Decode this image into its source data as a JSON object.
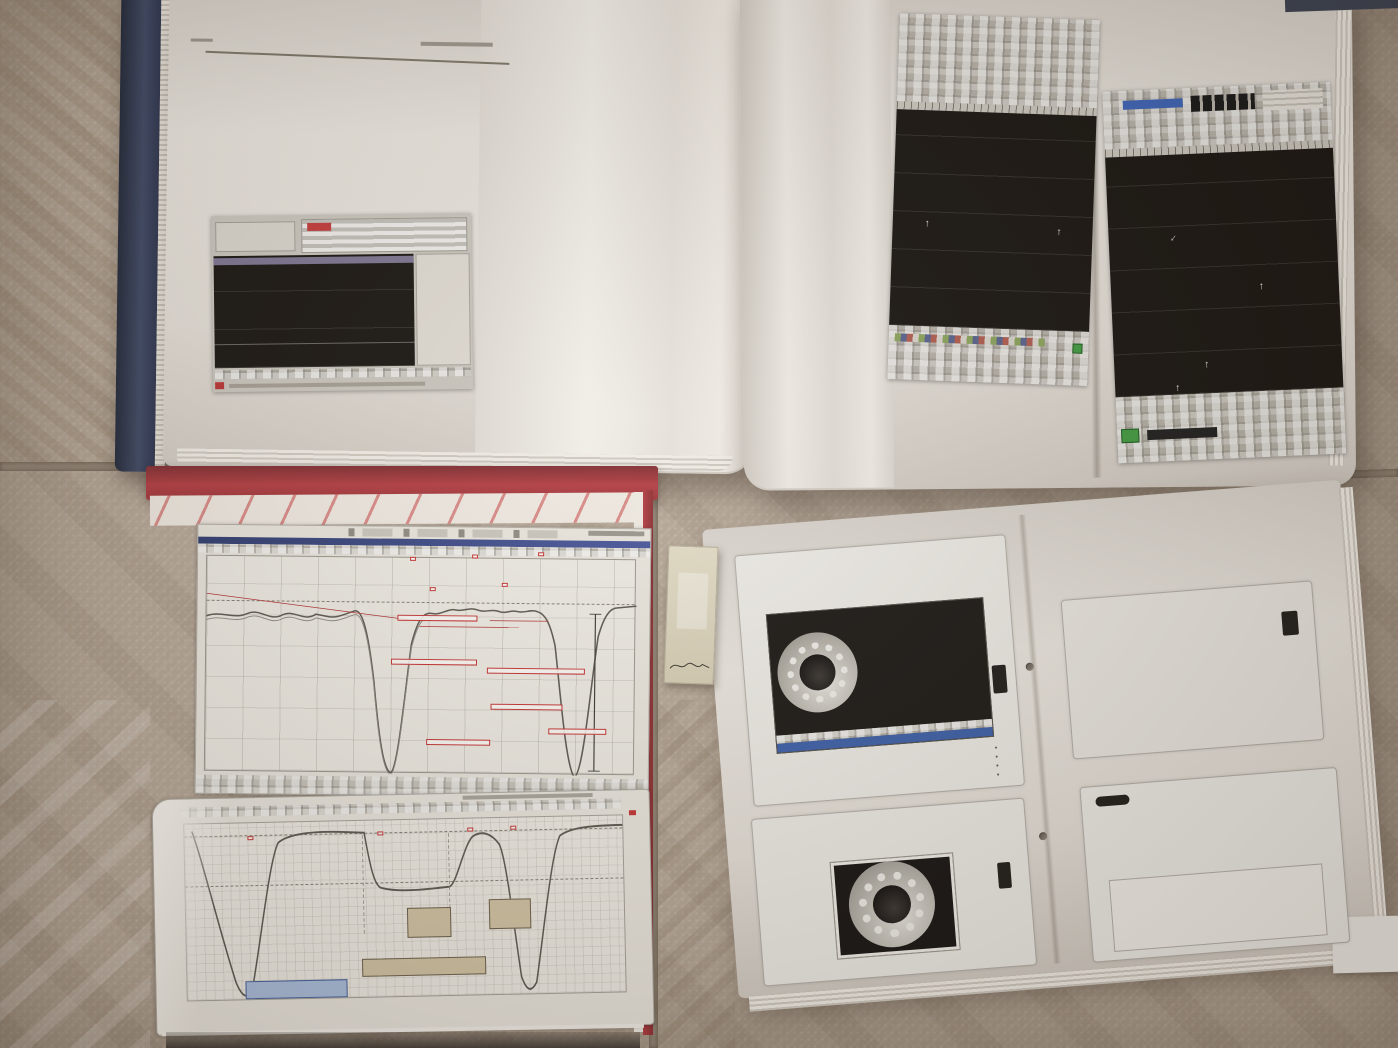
{
  "watermark": {
    "text": "微信订阅公众号：汽车诊断高阶波形解疑及实战教学",
    "color": "#ffffff",
    "angle_deg": -21,
    "instances": [
      {
        "x": -20,
        "y": 190
      },
      {
        "x": 575,
        "y": 190
      },
      {
        "x": 1150,
        "y": 200
      },
      {
        "x": -20,
        "y": 855
      },
      {
        "x": 585,
        "y": 825
      },
      {
        "x": 1155,
        "y": 868
      },
      {
        "x": -265,
        "y": 1315
      },
      {
        "x": 235,
        "y": 1325
      }
    ]
  },
  "colors": {
    "floor": "#b5a696",
    "grout": "#8f8273",
    "spine_navy": "#2b3147",
    "cover_red": "#a83236",
    "annotation_red": "#cc2f2f",
    "title_red": "#b5443c",
    "plot_black": "#161310",
    "waveform_red": "#c04038",
    "trace_green": "#4d8f4a",
    "accent_blue": "#3a5ea8"
  },
  "top_right_book": {
    "left_page": {
      "caption_line1": "Cranking Vacuum Waveform Using -30HG Sensor",
      "caption_line2": "Exhaust Valve not Opening",
      "label_1": "Positive Pressure Spike",
      "label_2": "Intake Valve Opened"
    },
    "right_page": {
      "caption_line1": "Cranking Vacuum Waveform Using -30 HG Sensor",
      "caption_line2": "Exhaust Valve not Opening",
      "label_1": "Intake Valve Opened",
      "label_2": "Intake Valve Closed",
      "label_3": "Positive Pressure Spike",
      "label_4": "Intake Valve Closed",
      "label_5": "Intake Valve Opened"
    }
  },
  "bottom_left_book": {
    "chart1": {
      "bdc_tag_1": "166 BDC",
      "bdc_tag_2": "164 BDC",
      "bdc_tag_3": "166 BDC",
      "arrow_tag_1": "EVO",
      "arrow_tag_2": "EVC",
      "ann_1": "NO RIPPLE OF INLET AIR ON WEAK CYL?",
      "ann_2": "GOOD GAS RIPPLE DURING EX OF GAS REF AND NRM CYLS",
      "ann_3": "WEAK CYL HIGHER INITIAL EX GAS PRESSURE THAN REF CYL",
      "ann_4": "WEAK CYL PEAK COMPRESSION TDC",
      "ann_5": "REF CYL PEAK COMPRESSION TDC",
      "ann_6": "DIFFERENCES IN PEAK PRESSURE"
    },
    "chart2": {
      "tag_1": "230",
      "tag_2": "366",
      "tag_3": "126",
      "tag_4": "1"
    }
  },
  "bottom_right_book": {
    "header_links": [
      "www.mobiusinstitute.com",
      "Copyright © 2014 Mobius Institute",
      "learn@mobiusinstitute.com"
    ],
    "slide_l1": {
      "title": "Vibration analysis: Enveloping",
      "bullet_1": "Filter out the low frequency, high amplitude vibration",
      "bullet_2": "'Rectify' the vibration signal",
      "bullet_3": "Using low pass filter to 'smooth' the data",
      "bullet_4": "View as a time waveform or spectrum"
    },
    "slide_l2": {
      "title": "Vibration analysis: Enveloping",
      "bullet_1": "In the early stage of bearing failure, the vibration is unique:",
      "bullet_2": "very low amplitude and very high frequency"
    },
    "slide_r1": {
      "title_line1": "Enveloping (also known as",
      "title_line2": "demodulation)",
      "subtitle": "Using accelerometer enveloping to detect faults"
    },
    "slide_r2": {
      "title": "Bearing faults: Ball on roller defect",
      "caption": "Fault on the ball/roller",
      "bullet": "Ball vibrations - harmonics - high frequency vibrations",
      "peak_labels": [
        "1x",
        "2x",
        "3x",
        "4x",
        "5x",
        "6x"
      ]
    },
    "footer_page": "Page 38 of 43",
    "footer_course": "2014 - Vibration Analysis and Bearing Fault Detection"
  },
  "bookmark": {
    "brand": "DAEWOO"
  }
}
